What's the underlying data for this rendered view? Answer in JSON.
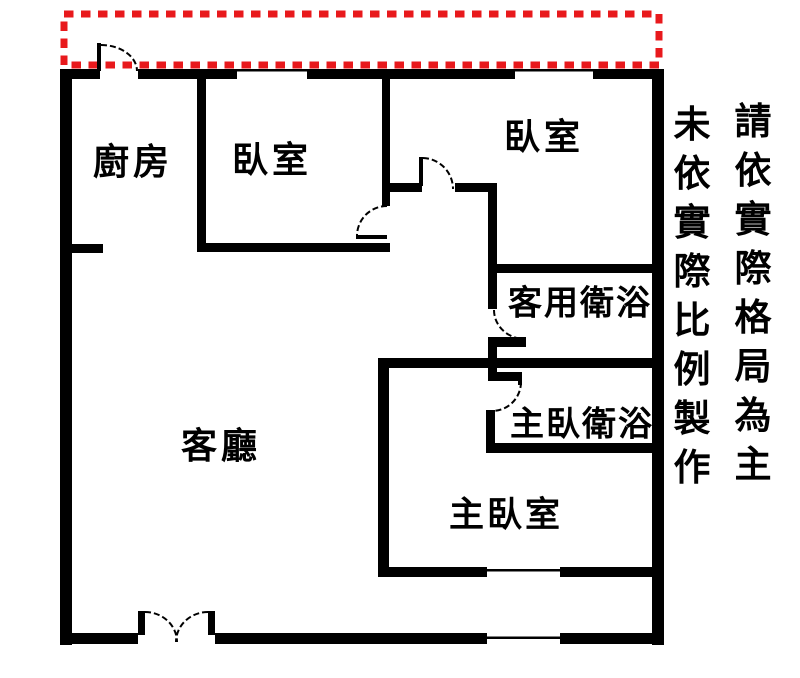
{
  "plan": {
    "rooms": {
      "kitchen": {
        "label": "廚房"
      },
      "bedroom1": {
        "label": "臥室"
      },
      "bedroom2": {
        "label": "臥室"
      },
      "guest_bathroom": {
        "label": "客用衛浴"
      },
      "master_bathroom": {
        "label": "主臥衛浴"
      },
      "master_bedroom": {
        "label": "主臥室"
      },
      "living_room": {
        "label": "客廳"
      }
    },
    "disclaimer": {
      "right_column": "請依實際格局為主",
      "left_column": "未依實際比例製作"
    },
    "colors": {
      "wall": "#000000",
      "balcony_dashed_outline": "#e8191c",
      "background": "#ffffff"
    }
  }
}
